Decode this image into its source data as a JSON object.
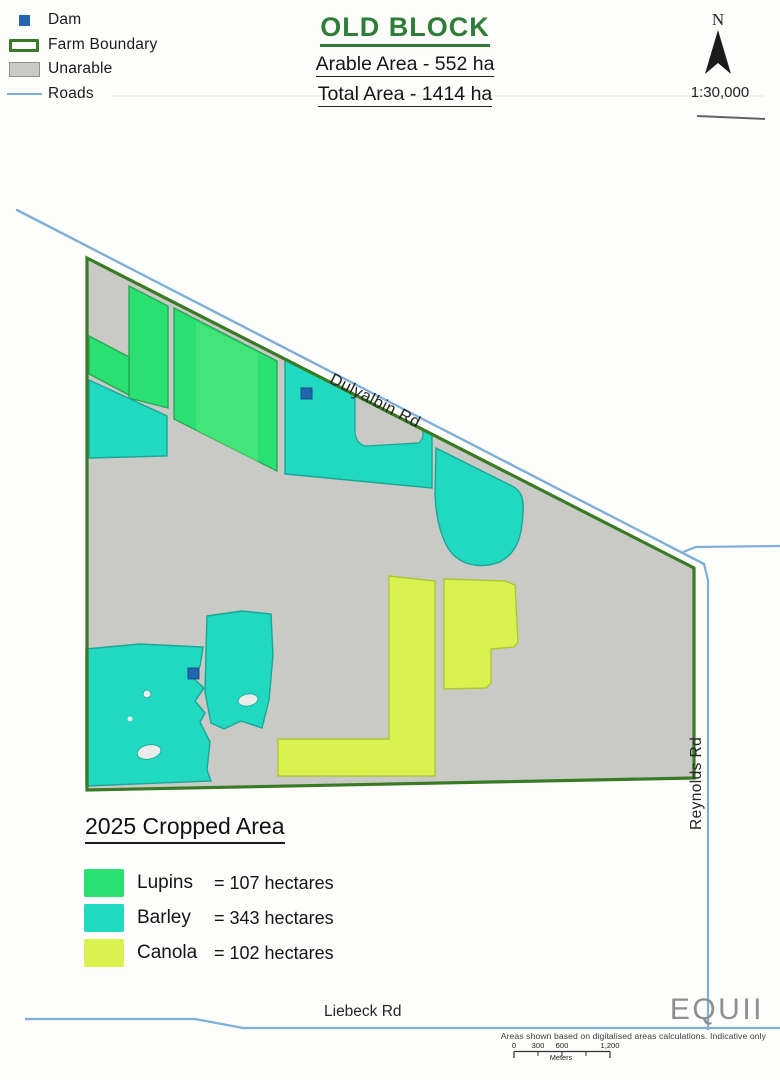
{
  "map_legend": {
    "items": [
      {
        "label": "Dam"
      },
      {
        "label": "Farm Boundary"
      },
      {
        "label": "Unarable"
      },
      {
        "label": "Roads"
      }
    ]
  },
  "title_block": {
    "title": "OLD BLOCK",
    "arable_area": "Arable Area - 552 ha",
    "total_area": "Total Area - 1414 ha"
  },
  "north_arrow": {
    "label": "N"
  },
  "map_scale": "1:30,000",
  "roads": {
    "dulyalbin": "Dulyalbin Rd",
    "reynolds": "Reynolds Rd",
    "liebeck": "Liebeck Rd"
  },
  "cropped_area": {
    "heading": "2025 Cropped Area",
    "items": [
      {
        "crop": "Lupins",
        "value": "= 107 hectares"
      },
      {
        "crop": "Barley",
        "value": "= 343 hectares"
      },
      {
        "crop": "Canola",
        "value": "= 102 hectares"
      }
    ]
  },
  "footer": {
    "logo": "EQUII",
    "disclaimer": "Areas shown based on digitalised areas calculations. Indicative only",
    "scale_bar": {
      "labels": [
        "0",
        "300",
        "600",
        "1,200"
      ],
      "unit": "Meters"
    }
  },
  "colors": {
    "lupins": "#2ae070",
    "barley": "#21d8c1",
    "canola": "#d9f24f",
    "dam": "#2166ae",
    "farm_boundary": "#3a7a24",
    "unarable": "#c9c9c5",
    "road": "#7eafd6",
    "title_green": "#2e7d38",
    "logo_gray": "#8f8f8f"
  }
}
